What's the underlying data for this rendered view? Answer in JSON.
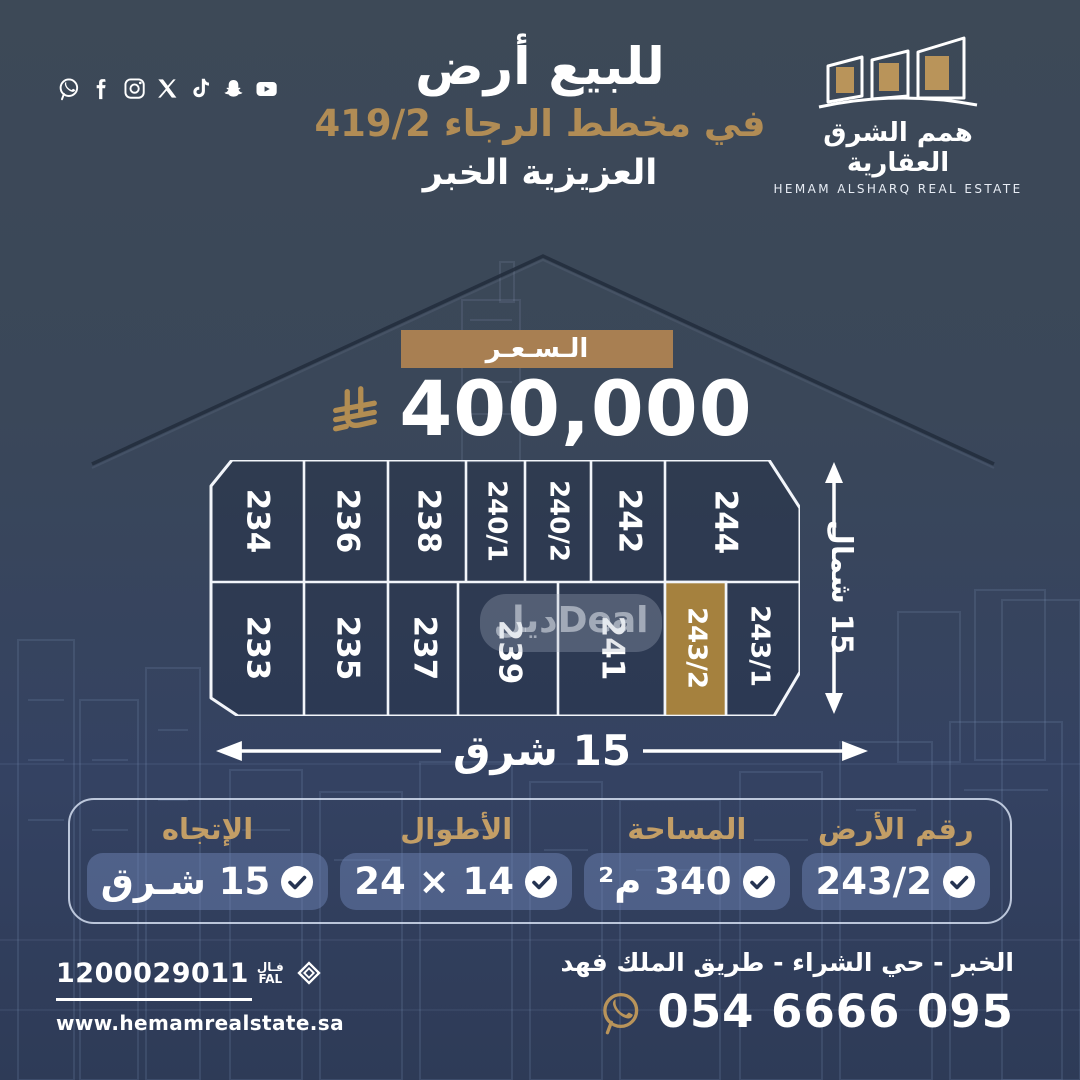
{
  "colors": {
    "background_top": "#3d4957",
    "background_bottom": "#2e3b57",
    "gold": "#b28d52",
    "banner_gold": "#a87f52",
    "plot_gold": "#a5813e",
    "label_gold": "#c39e66",
    "check_navy": "#263452",
    "pill_blue": "rgba(116,138,188,0.45)"
  },
  "social": {
    "icons": [
      "whatsapp",
      "facebook",
      "instagram",
      "x-twitter",
      "tiktok",
      "snapchat",
      "youtube"
    ]
  },
  "header": {
    "title_line1": "للبيع أرض",
    "title_line2": "في مخطط الرجاء 419/2",
    "title_line3": "العزيزية الخبر",
    "logo": {
      "name_ar": "همم الشرق العقارية",
      "name_en": "HEMAM ALSHARQ REAL ESTATE"
    }
  },
  "price": {
    "label": "الـسـعـر",
    "amount": "400,000",
    "currency": "saudi-riyal"
  },
  "map": {
    "north_label": "15 شمال",
    "east_label": "15 شرق",
    "watermark": "ديلDeal",
    "highlighted_plot": "243/2",
    "top_row": [
      "234",
      "236",
      "238",
      "240/1",
      "240/2",
      "242",
      "244"
    ],
    "bottom_row": [
      "233",
      "235",
      "237",
      "239",
      "241",
      "243/2",
      "243/1"
    ]
  },
  "details": [
    {
      "label": "رقم الأرض",
      "value": "243/2"
    },
    {
      "label": "المساحة",
      "value": "340 م²"
    },
    {
      "label": "الأطوال",
      "value": "14 × 24"
    },
    {
      "label": "الإتجاه",
      "value": "15 شـرق"
    }
  ],
  "footer": {
    "fal_number": "1200029011",
    "fal_ar": "فـال",
    "fal_en": "FAL",
    "website": "www.hemamrealstate.sa",
    "address": "الخبر - حي الشراء - طريق الملك فهد",
    "phone": "054 6666 095"
  }
}
